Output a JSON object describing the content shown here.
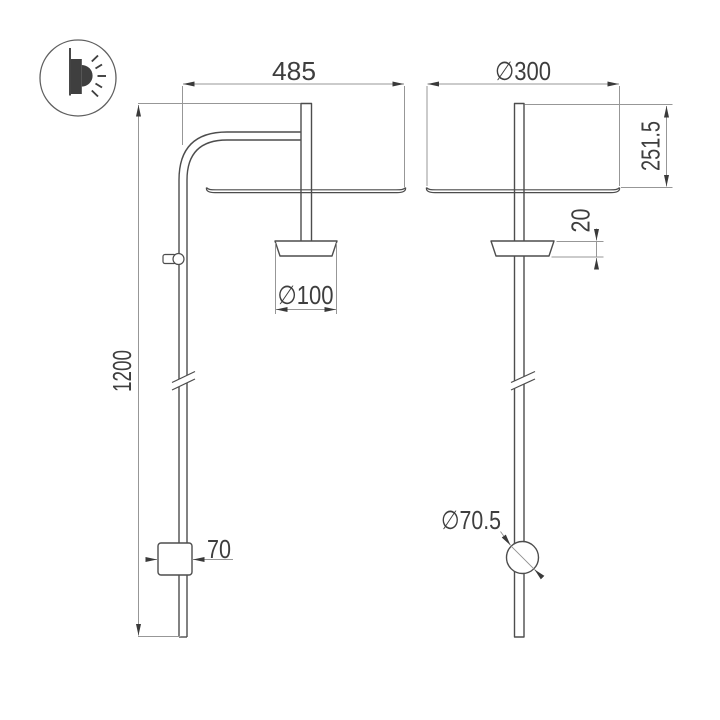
{
  "title": "wall-lamp-technical-drawing",
  "icon": {
    "wall_lamp": "wall-lamp-icon"
  },
  "colors": {
    "background": "#ffffff",
    "object_line": "#4d4d4d",
    "dimension_line": "#979797",
    "text": "#3e3e3e",
    "icon_fill": "#3f3f3f"
  },
  "dimensions": {
    "arm_projection": "485",
    "shade_diameter": "∅300",
    "total_height": "1200",
    "head_drop": "251.5",
    "holder_height": "20",
    "holder_diameter": "∅100",
    "wall_bracket_width": "70",
    "wall_cup_diameter": "∅70.5"
  }
}
